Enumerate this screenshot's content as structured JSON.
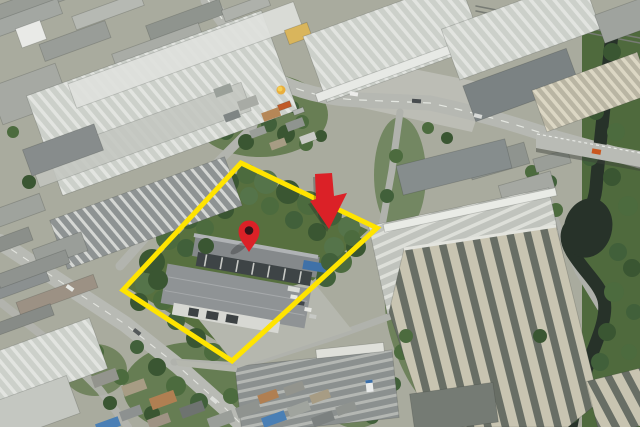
{
  "image": {
    "kind": "oblique-aerial-photograph",
    "scene": "industrial estate with warehouses, canal and highlighted land plot",
    "width": 640,
    "height": 427
  },
  "annotations": {
    "property_boundary": {
      "shape": "quadrilateral",
      "color": "#FFE400",
      "stroke_width": 5,
      "points": "241,163 377,228 232,361 123,290"
    },
    "down_arrow": {
      "color": "#DB2127",
      "points": "315,174 332,173 334,196 347,193 329,229 310,201 316,199",
      "shadow_offset": [
        -2,
        3
      ]
    },
    "location_pin": {
      "color": "#DB2127",
      "hole_color": "#351419",
      "cx": 249,
      "cy": 231,
      "r": 10.5,
      "tip_y": 252
    }
  },
  "palette": {
    "ground": "#A9AB9E",
    "road": "#B6B8B2",
    "road_marking": "#ECEEE9",
    "canal_water": "#273229",
    "boat_teal": "#3F8D86",
    "vegetation_dark": "#3A5632",
    "vegetation_mid": "#4C6B3E",
    "vegetation_light": "#55744A",
    "roof_white": "#DFE1DD",
    "roof_light": "#CCD0CA",
    "roof_gray": "#8E9393",
    "roof_dark": "#7B8283",
    "roof_cream": "#C8C4B1",
    "roof_rust": "#B07F52",
    "roof_blue": "#4A7FB5",
    "awning_blue": "#3F71A8"
  }
}
